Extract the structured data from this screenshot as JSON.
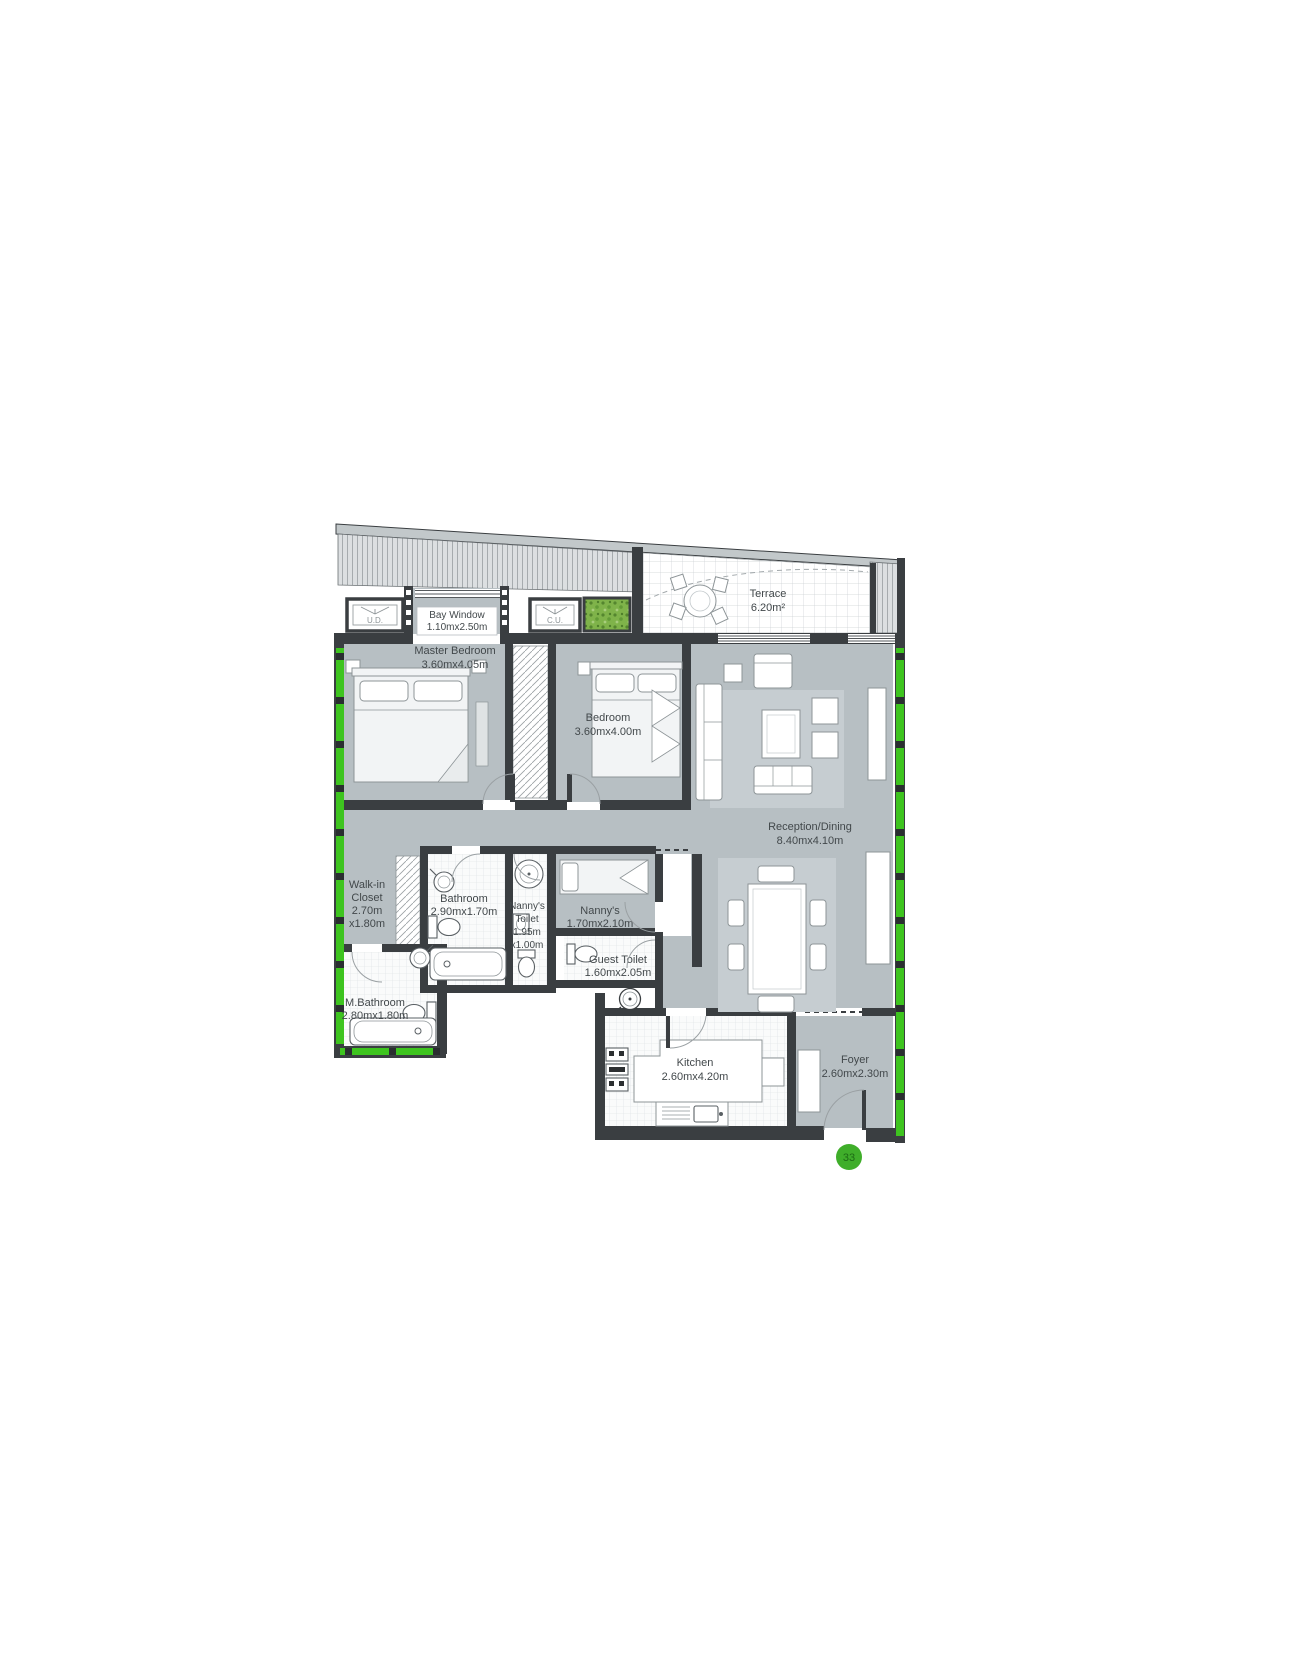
{
  "plan": {
    "unit_badge": "33",
    "rooms": {
      "terrace": {
        "name": "Terrace",
        "dims": "6.20m²"
      },
      "bay_window": {
        "name": "Bay Window",
        "dims": "1.10mx2.50m"
      },
      "master_bedroom": {
        "name": "Master Bedroom",
        "dims": "3.60mx4.05m"
      },
      "bedroom": {
        "name": "Bedroom",
        "dims": "3.60mx4.00m"
      },
      "reception": {
        "name": "Reception/Dining",
        "dims": "8.40mx4.10m"
      },
      "walk_in_closet": {
        "line1": "Walk-in",
        "line2": "Closet",
        "line3": "2.70m",
        "line4": "x1.80m"
      },
      "bathroom": {
        "name": "Bathroom",
        "dims": "2.90mx1.70m"
      },
      "nannys_toilet": {
        "line1": "Nanny's",
        "line2": "Toilet",
        "line3": "1.95m",
        "line4": "x1.00m"
      },
      "nannys_room": {
        "name": "Nanny's",
        "dims": "1.70mx2.10m"
      },
      "guest_toilet": {
        "name": "Guest Toilet",
        "dims": "1.60mx2.05m"
      },
      "m_bathroom": {
        "name": "M.Bathroom",
        "dims": "2.80mx1.80m"
      },
      "kitchen": {
        "name": "Kitchen",
        "dims": "2.60mx4.20m"
      },
      "foyer": {
        "name": "Foyer",
        "dims": "2.60mx2.30m"
      }
    },
    "equipment": {
      "unit_left": "U.D.",
      "unit_right": "C.U."
    },
    "colors": {
      "wall": "#3a3e41",
      "floor": "#b7bfc3",
      "glazing_green": "#3ec41f",
      "badge_green": "#3fae2a",
      "planter_green": "#7fb34a"
    }
  }
}
